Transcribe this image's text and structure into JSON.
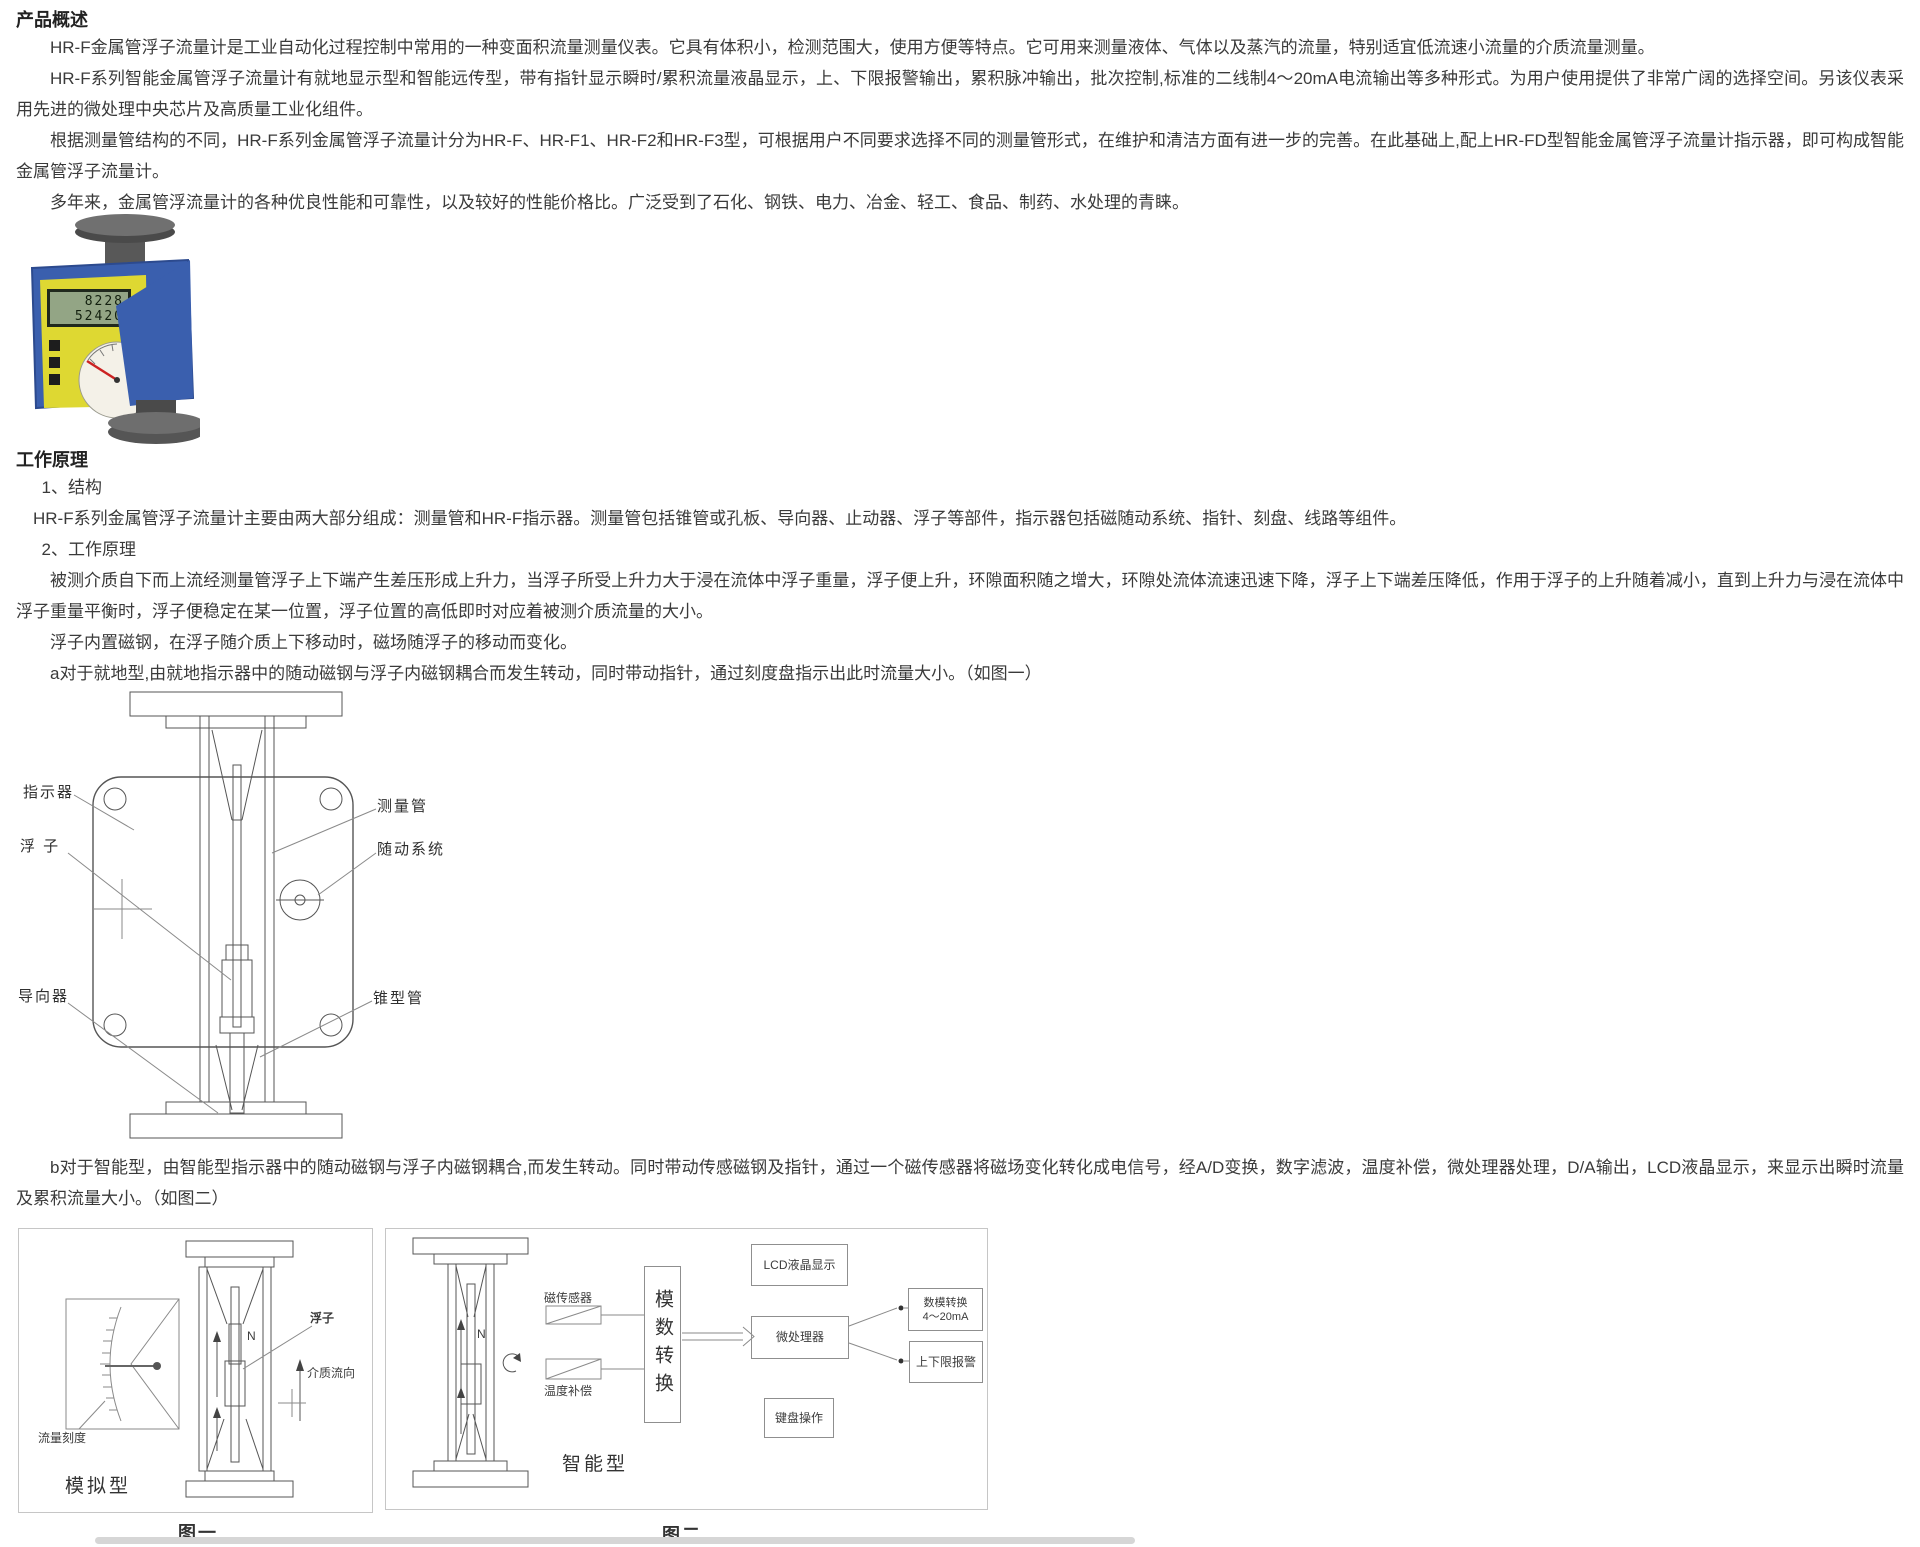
{
  "overview": {
    "heading": "产品概述",
    "p1": "HR-F金属管浮子流量计是工业自动化过程控制中常用的一种变面积流量测量仪表。它具有体积小，检测范围大，使用方便等特点。它可用来测量液体、气体以及蒸汽的流量，特别适宜低流速小流量的介质流量测量。",
    "p2": "HR-F系列智能金属管浮子流量计有就地显示型和智能远传型，带有指针显示瞬时/累积流量液晶显示，上、下限报警输出，累积脉冲输出，批次控制,标准的二线制4～20mA电流输出等多种形式。为用户使用提供了非常广阔的选择空间。另该仪表采用先进的微处理中央芯片及高质量工业化组件。",
    "p3": "根据测量管结构的不同，HR-F系列金属管浮子流量计分为HR-F、HR-F1、HR-F2和HR-F3型，可根据用户不同要求选择不同的测量管形式，在维护和清洁方面有进一步的完善。在此基础上,配上HR-FD型智能金属管浮子流量计指示器，即可构成智能金属管浮子流量计。",
    "p4": "多年来，金属管浮流量计的各种优良性能和可靠性，以及较好的性能价格比。广泛受到了石化、钢铁、电力、冶金、轻工、食品、制药、水处理的青睐。"
  },
  "photo": {
    "lcd_line1": "8228",
    "lcd_line2": "52420"
  },
  "principle": {
    "heading": "工作原理",
    "s1_title": "1、结构",
    "s1_text": "HR-F系列金属管浮子流量计主要由两大部分组成：测量管和HR-F指示器。测量管包括锥管或孔板、导向器、止动器、浮子等部件，指示器包括磁随动系统、指针、刻盘、线路等组件。",
    "s2_title": "2、工作原理",
    "s2_p1": "被测介质自下而上流经测量管浮子上下端产生差压形成上升力，当浮子所受上升力大于浸在流体中浮子重量，浮子便上升，环隙面积随之增大，环隙处流体流速迅速下降，浮子上下端差压降低，作用于浮子的上升随着减小，直到上升力与浸在流体中浮子重量平衡时，浮子便稳定在某一位置，浮子位置的高低即时对应着被测介质流量的大小。",
    "s2_p2": "浮子内置磁钢，在浮子随介质上下移动时，磁场随浮子的移动而变化。",
    "s2_pa": "a对于就地型,由就地指示器中的随动磁钢与浮子内磁钢耦合而发生转动，同时带动指针，通过刻度盘指示出此时流量大小。（如图一）",
    "s2_pb": "b对于智能型，由智能型指示器中的随动磁钢与浮子内磁钢耦合,而发生转动。同时带动传感磁钢及指针，通过一个磁传感器将磁场变化转化成电信号，经A/D变换，数字滤波，温度补偿，微处理器处理，D/A输出，LCD液晶显示，来显示出瞬时流量及累积流量大小。（如图二）"
  },
  "diagram": {
    "label_indicator": "指示器",
    "label_float": "浮 子",
    "label_guide": "导向器",
    "label_tube": "测量管",
    "label_follower": "随动系统",
    "label_cone": "锥型管"
  },
  "figure1": {
    "label_scale": "流量刻度",
    "label_type": "模拟型",
    "label_float": "浮子",
    "label_flow": "介质流向",
    "label_n": "N",
    "caption": "图一"
  },
  "figure2": {
    "label_sensor": "磁传感器",
    "label_temp": "温度补偿",
    "label_adc": "模数转换",
    "label_lcd": "LCD液晶显示",
    "label_mcu": "微处理器",
    "label_keyboard": "键盘操作",
    "label_dac1": "数模转换",
    "label_dac2": "4～20mA",
    "label_alarm": "上下限报警",
    "label_n": "N",
    "label_type": "智能型",
    "caption": "图二"
  }
}
